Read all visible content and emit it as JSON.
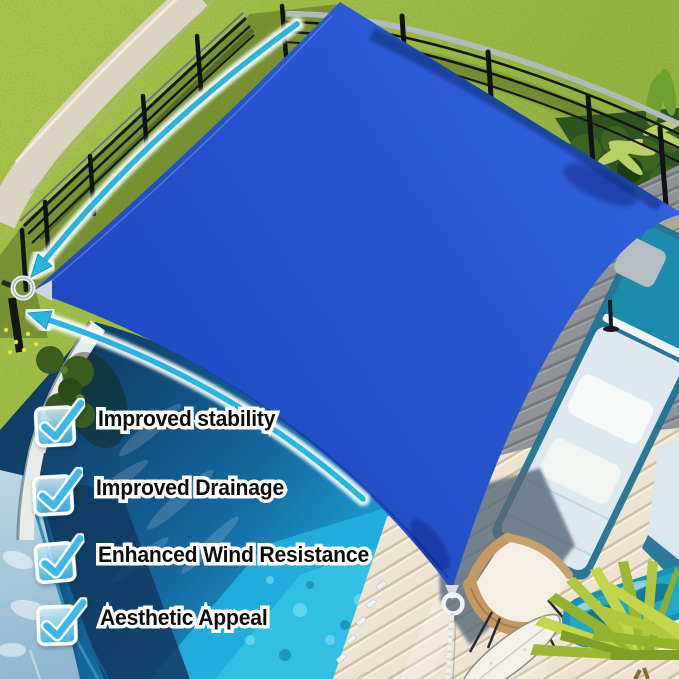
{
  "canvas": {
    "width": 679,
    "height": 679
  },
  "features": {
    "items": [
      {
        "label": "Improved stability",
        "checked": true
      },
      {
        "label": "Improved Drainage",
        "checked": true
      },
      {
        "label": "Enhanced Wind Resistance",
        "checked": true
      },
      {
        "label": "Aesthetic Appeal",
        "checked": true
      }
    ]
  },
  "icons": {
    "checkbox": "checked-checkbox-icon",
    "upper_arrow": "curved-arrow-icon",
    "lower_arrow": "curved-arrow-icon",
    "left_corner_ring": "metal-ring-icon",
    "bottom_corner_ring": "d-ring-icon"
  },
  "colors": {
    "sail_blue": "#2456d2",
    "sail_blue_light": "#3166e4",
    "sail_blue_dark": "#1f49c5",
    "arrow_cyan": "#28b5e0",
    "check_blue": "#3cb7ea",
    "checkbox_fill_light": "#e8f8fe",
    "checkbox_fill_deep": "#3eb9ea",
    "label_text": "#0e0e0e",
    "label_outline": "#ffffff",
    "grass_green": "#8db338",
    "pool_dark_blue": "#0f3e66",
    "pool_bright_cyan": "#22aedd",
    "deck_gray": "#8f9396",
    "deck_cream": "#eee3d1"
  }
}
